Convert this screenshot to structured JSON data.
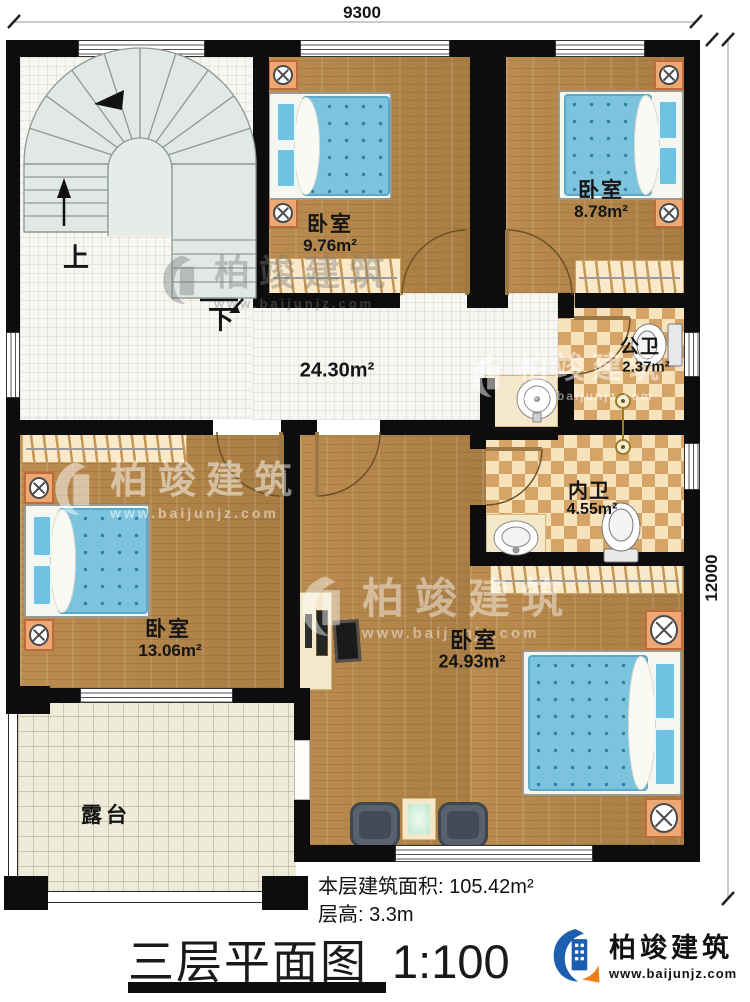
{
  "dimensions": {
    "top_width": "9300",
    "right_height": "12000"
  },
  "stairs": {
    "up": "上",
    "down": "下"
  },
  "rooms": {
    "bedroom_top_mid": {
      "name": "卧室",
      "area": "9.76m²"
    },
    "bedroom_top_right": {
      "name": "卧室",
      "area": "8.78m²"
    },
    "hall": {
      "area": "24.30m²"
    },
    "public_bath": {
      "name": "公卫",
      "area": "2.37m²"
    },
    "ensuite_bath": {
      "name": "内卫",
      "area": "4.55m²"
    },
    "bedroom_left": {
      "name": "卧室",
      "area": "13.06m²"
    },
    "master_bedroom": {
      "name": "卧室",
      "area": "24.93m²"
    },
    "terrace": {
      "name": "露台"
    }
  },
  "footer": {
    "floor_area_label": "本层建筑面积:",
    "floor_area_value": "105.42m²",
    "floor_height_label": "层高:",
    "floor_height_value": "3.3m",
    "title": "三层平面图",
    "scale": "1:100"
  },
  "brand": {
    "name": "柏竣建筑",
    "website": "www.baijunjz.com"
  },
  "colors": {
    "wall": "#0d0d0d",
    "wood_floor": "#b3854a",
    "bed_blue": "#7cc4de",
    "brand_blue": "#1c5fae",
    "brand_orange": "#ed7d18"
  }
}
